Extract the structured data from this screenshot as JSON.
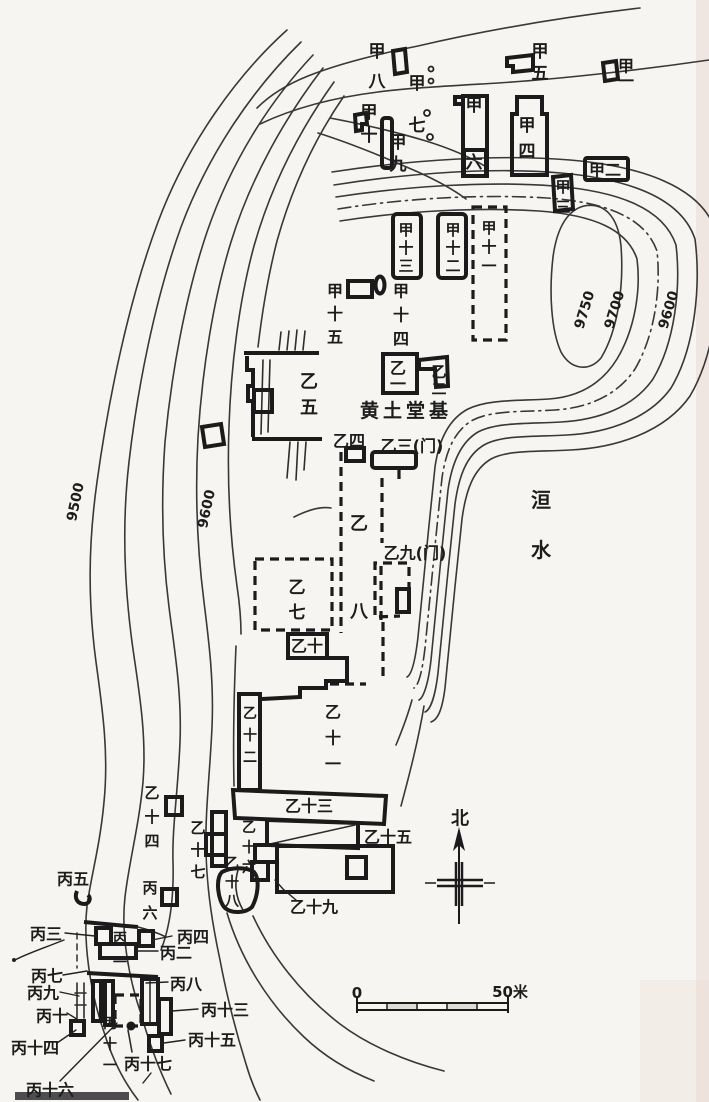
{
  "colors": {
    "paper": "#f6f5f1",
    "ink": "#1c1c1c",
    "scan_tint": "#e9d7d2",
    "scan_bar": "#4d4d4d"
  },
  "compass": {
    "north_label": "北"
  },
  "scale_bar": {
    "start_label": "0",
    "end_label": "50米"
  },
  "river_label": "洹水",
  "core_label": "黄土堂基",
  "contour_values": [
    "9500",
    "9600",
    "9700",
    "9750"
  ],
  "labels": [
    {
      "id": "jia-8",
      "text": "甲八",
      "x": 377,
      "y": 52,
      "v": true,
      "lh": 30,
      "s": 17
    },
    {
      "id": "jia-7",
      "text": "甲七",
      "x": 417,
      "y": 84,
      "v": true,
      "lh": 42,
      "s": 17
    },
    {
      "id": "jia-5",
      "text": "甲五",
      "x": 540,
      "y": 52,
      "v": true,
      "lh": 22,
      "s": 17
    },
    {
      "id": "jia-1",
      "text": "甲一",
      "x": 626,
      "y": 66,
      "v": true,
      "lh": 15,
      "s": 16
    },
    {
      "id": "jia-10",
      "text": "甲十",
      "x": 369,
      "y": 113,
      "v": true,
      "lh": 23,
      "s": 17
    },
    {
      "id": "jia-9",
      "text": "甲九",
      "x": 398,
      "y": 143,
      "v": true,
      "lh": 22,
      "s": 17
    },
    {
      "id": "jia-6",
      "text": "甲六",
      "x": 474,
      "y": 106,
      "v": true,
      "lh": 57,
      "s": 17
    },
    {
      "id": "jia-4",
      "text": "甲四",
      "x": 527,
      "y": 126,
      "v": true,
      "lh": 26,
      "s": 17
    },
    {
      "id": "jia-2",
      "text": "甲二",
      "x": 605,
      "y": 170,
      "s": 16
    },
    {
      "id": "jia-3",
      "text": "甲三",
      "x": 563,
      "y": 187,
      "v": true,
      "lh": 20,
      "s": 15
    },
    {
      "id": "jia-13",
      "text": "甲十三",
      "x": 406,
      "y": 230,
      "v": true,
      "lh": 18,
      "s": 15
    },
    {
      "id": "jia-12",
      "text": "甲十二",
      "x": 453,
      "y": 230,
      "v": true,
      "lh": 18,
      "s": 15
    },
    {
      "id": "jia-11",
      "text": "甲十一",
      "x": 489,
      "y": 228,
      "v": true,
      "lh": 19,
      "s": 15
    },
    {
      "id": "jia-15",
      "text": "甲十五",
      "x": 335,
      "y": 291,
      "v": true,
      "lh": 23,
      "s": 16
    },
    {
      "id": "jia-14",
      "text": "甲十四",
      "x": 401,
      "y": 291,
      "v": true,
      "lh": 24,
      "s": 16
    },
    {
      "id": "yi-1",
      "text": "乙一",
      "x": 398,
      "y": 368,
      "v": true,
      "lh": 16,
      "s": 16
    },
    {
      "id": "yi-2",
      "text": "乙二",
      "x": 439,
      "y": 372,
      "v": true,
      "lh": 17,
      "s": 15
    },
    {
      "id": "core",
      "text": "黄土堂基",
      "x": 406,
      "y": 411,
      "s": 19,
      "b": true,
      "ls": 4
    },
    {
      "id": "yi-5",
      "text": "乙五",
      "x": 309,
      "y": 382,
      "v": true,
      "lh": 26,
      "s": 18
    },
    {
      "id": "yi-4",
      "text": "乙四",
      "x": 349,
      "y": 441,
      "s": 16
    },
    {
      "id": "yi-3",
      "text": "乙三(门)",
      "x": 412,
      "y": 446,
      "s": 16
    },
    {
      "id": "yi-8",
      "text": "乙八",
      "x": 359,
      "y": 524,
      "v": true,
      "lh": 88,
      "s": 18
    },
    {
      "id": "yi-9",
      "text": "乙九(门)",
      "x": 415,
      "y": 553,
      "s": 16
    },
    {
      "id": "yi-7",
      "text": "乙七",
      "x": 297,
      "y": 588,
      "v": true,
      "lh": 25,
      "s": 17
    },
    {
      "id": "yi-10",
      "text": "乙十",
      "x": 307,
      "y": 646,
      "s": 16
    },
    {
      "id": "yi-12",
      "text": "乙十二",
      "x": 250,
      "y": 714,
      "v": true,
      "lh": 22,
      "s": 14
    },
    {
      "id": "yi-11",
      "text": "乙十一",
      "x": 333,
      "y": 712,
      "v": true,
      "lh": 26,
      "s": 16
    },
    {
      "id": "yi-13",
      "text": "乙十三",
      "x": 309,
      "y": 806,
      "s": 16
    },
    {
      "id": "yi-15",
      "text": "乙十五",
      "x": 388,
      "y": 837,
      "s": 16
    },
    {
      "id": "yi-19",
      "text": "乙十九",
      "x": 314,
      "y": 907,
      "s": 16
    },
    {
      "id": "yi-14",
      "text": "乙十四",
      "x": 152,
      "y": 793,
      "v": true,
      "lh": 24,
      "s": 15
    },
    {
      "id": "yi-17",
      "text": "乙十七",
      "x": 198,
      "y": 828,
      "v": true,
      "lh": 22,
      "s": 15
    },
    {
      "id": "yi-16",
      "text": "乙十六",
      "x": 249,
      "y": 828,
      "v": true,
      "lh": 20,
      "s": 14
    },
    {
      "id": "yi-18",
      "text": "乙十八",
      "x": 232,
      "y": 864,
      "v": true,
      "lh": 19,
      "s": 14
    },
    {
      "id": "bing-5",
      "text": "丙五",
      "x": 73,
      "y": 879,
      "s": 16
    },
    {
      "id": "bing-6",
      "text": "丙六",
      "x": 150,
      "y": 888,
      "v": true,
      "lh": 25,
      "s": 15
    },
    {
      "id": "bing-4",
      "text": "丙四",
      "x": 193,
      "y": 937,
      "s": 16
    },
    {
      "id": "bing-3",
      "text": "丙三",
      "x": 46,
      "y": 934,
      "s": 16
    },
    {
      "id": "bing-1",
      "text": "丙一",
      "x": 120,
      "y": 939,
      "v": true,
      "lh": 24,
      "s": 14
    },
    {
      "id": "bing-2",
      "text": "丙二",
      "x": 176,
      "y": 953,
      "s": 16
    },
    {
      "id": "bing-7",
      "text": "丙七",
      "x": 47,
      "y": 976,
      "s": 16
    },
    {
      "id": "bing-9",
      "text": "丙九",
      "x": 43,
      "y": 993,
      "s": 16
    },
    {
      "id": "bing-8",
      "text": "丙八",
      "x": 186,
      "y": 984,
      "s": 16
    },
    {
      "id": "bing-10",
      "text": "丙十",
      "x": 52,
      "y": 1016,
      "s": 16
    },
    {
      "id": "bing-13",
      "text": "丙十三",
      "x": 225,
      "y": 1010,
      "s": 16
    },
    {
      "id": "bing-15",
      "text": "丙十五",
      "x": 212,
      "y": 1040,
      "s": 16
    },
    {
      "id": "bing-14",
      "text": "丙十四",
      "x": 35,
      "y": 1048,
      "s": 16
    },
    {
      "id": "bing-11",
      "text": "丙十一",
      "x": 110,
      "y": 1024,
      "v": true,
      "lh": 21,
      "s": 14
    },
    {
      "id": "bing-17",
      "text": "丙十七",
      "x": 148,
      "y": 1064,
      "s": 16
    },
    {
      "id": "bing-16",
      "text": "丙十六",
      "x": 50,
      "y": 1090,
      "s": 16
    },
    {
      "id": "river",
      "text": "洹水",
      "x": 541,
      "y": 500,
      "v": true,
      "lh": 50,
      "s": 20
    },
    {
      "id": "north",
      "text": "北",
      "x": 460,
      "y": 819,
      "s": 18
    },
    {
      "id": "contour-9500",
      "text": "9500",
      "x": 76,
      "y": 502,
      "rot": -78,
      "s": 14
    },
    {
      "id": "contour-9600-west",
      "text": "9600",
      "x": 207,
      "y": 509,
      "rot": -78,
      "s": 14
    },
    {
      "id": "contour-9750",
      "text": "9750",
      "x": 585,
      "y": 310,
      "rot": -73,
      "s": 14
    },
    {
      "id": "contour-9700",
      "text": "9700",
      "x": 615,
      "y": 310,
      "rot": -73,
      "s": 14
    },
    {
      "id": "contour-9600-east",
      "text": "9600",
      "x": 669,
      "y": 310,
      "rot": -73,
      "s": 14
    },
    {
      "id": "scale-start",
      "text": "0",
      "x": 357,
      "y": 993,
      "s": 15
    },
    {
      "id": "scale-end",
      "text": "50米",
      "x": 510,
      "y": 992,
      "s": 15
    }
  ]
}
